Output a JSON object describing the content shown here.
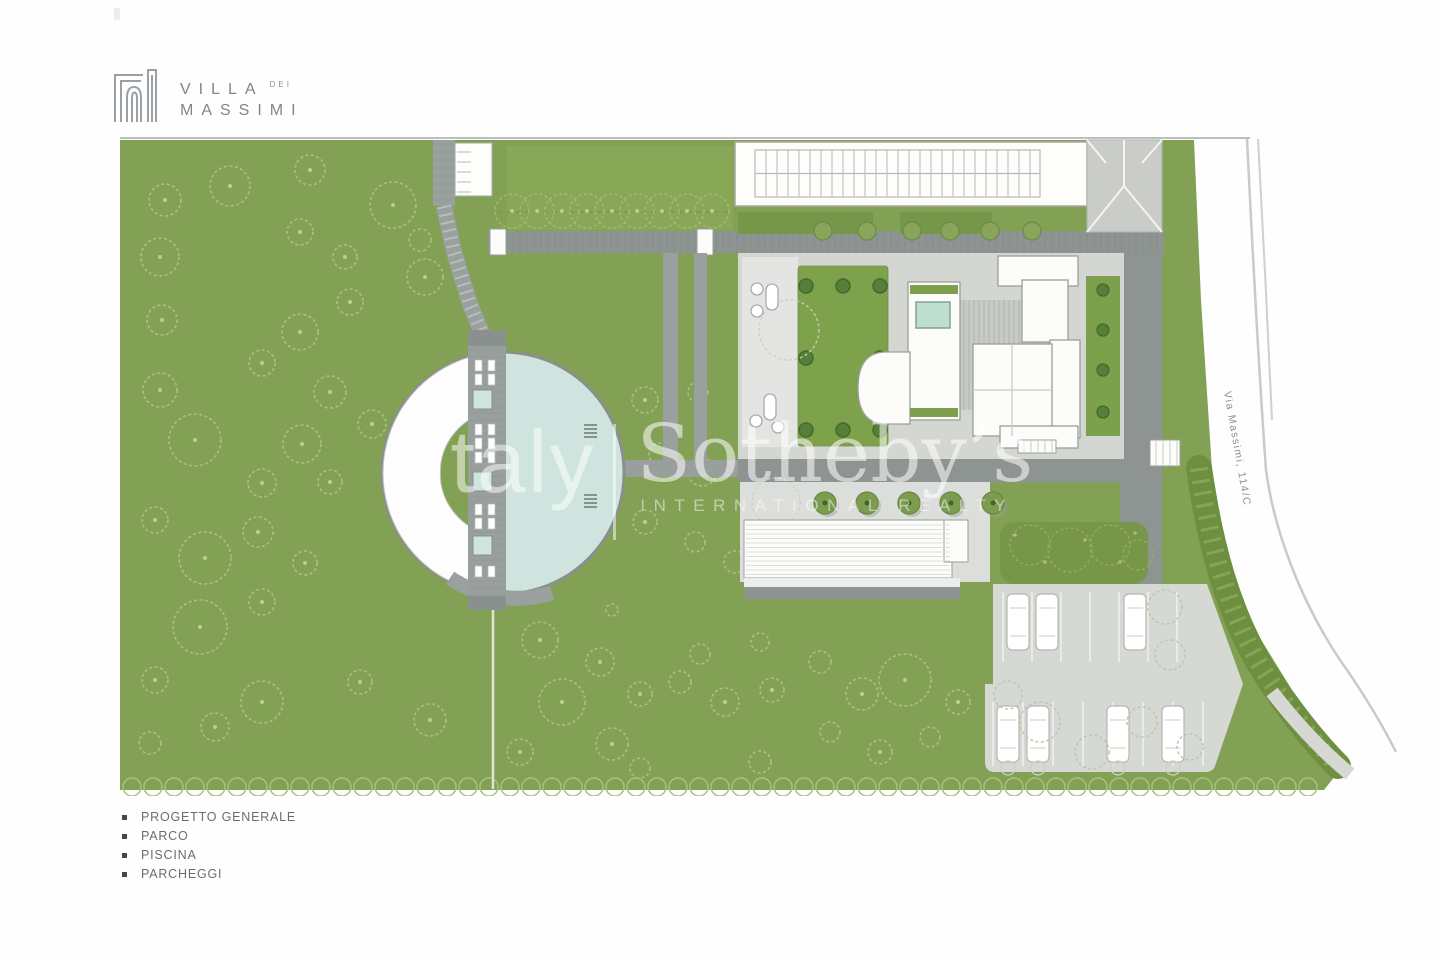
{
  "logo": {
    "line1": "VILLA",
    "dei": "DEI",
    "line2": "MASSIMI"
  },
  "watermark": {
    "market": "Italy",
    "brand": "Sotheby’s",
    "tagline": "INTERNATIONAL REALTY"
  },
  "plan": {
    "road_label": "Via Massimi, 114/C"
  },
  "legend": {
    "items": [
      "PROGETTO GENERALE",
      "PARCO",
      "PISCINA",
      "PARCHEGGI"
    ]
  },
  "colors": {
    "park_green": "#83a155",
    "tree_outline": "#a9c17e",
    "hedge_green": "#6f8f40",
    "courtyard_green": "#7ea24b",
    "pool_teal": "#cfe4de",
    "path_grey": "#999f9d",
    "dark_band": "#8e9492",
    "paving_light": "#d6d8d4",
    "building_white": "#fcfcfb",
    "outline_grey": "#9a9e9a",
    "logo_grey": "#81868a",
    "watermark_white": "rgba(255,255,255,0.55)"
  }
}
